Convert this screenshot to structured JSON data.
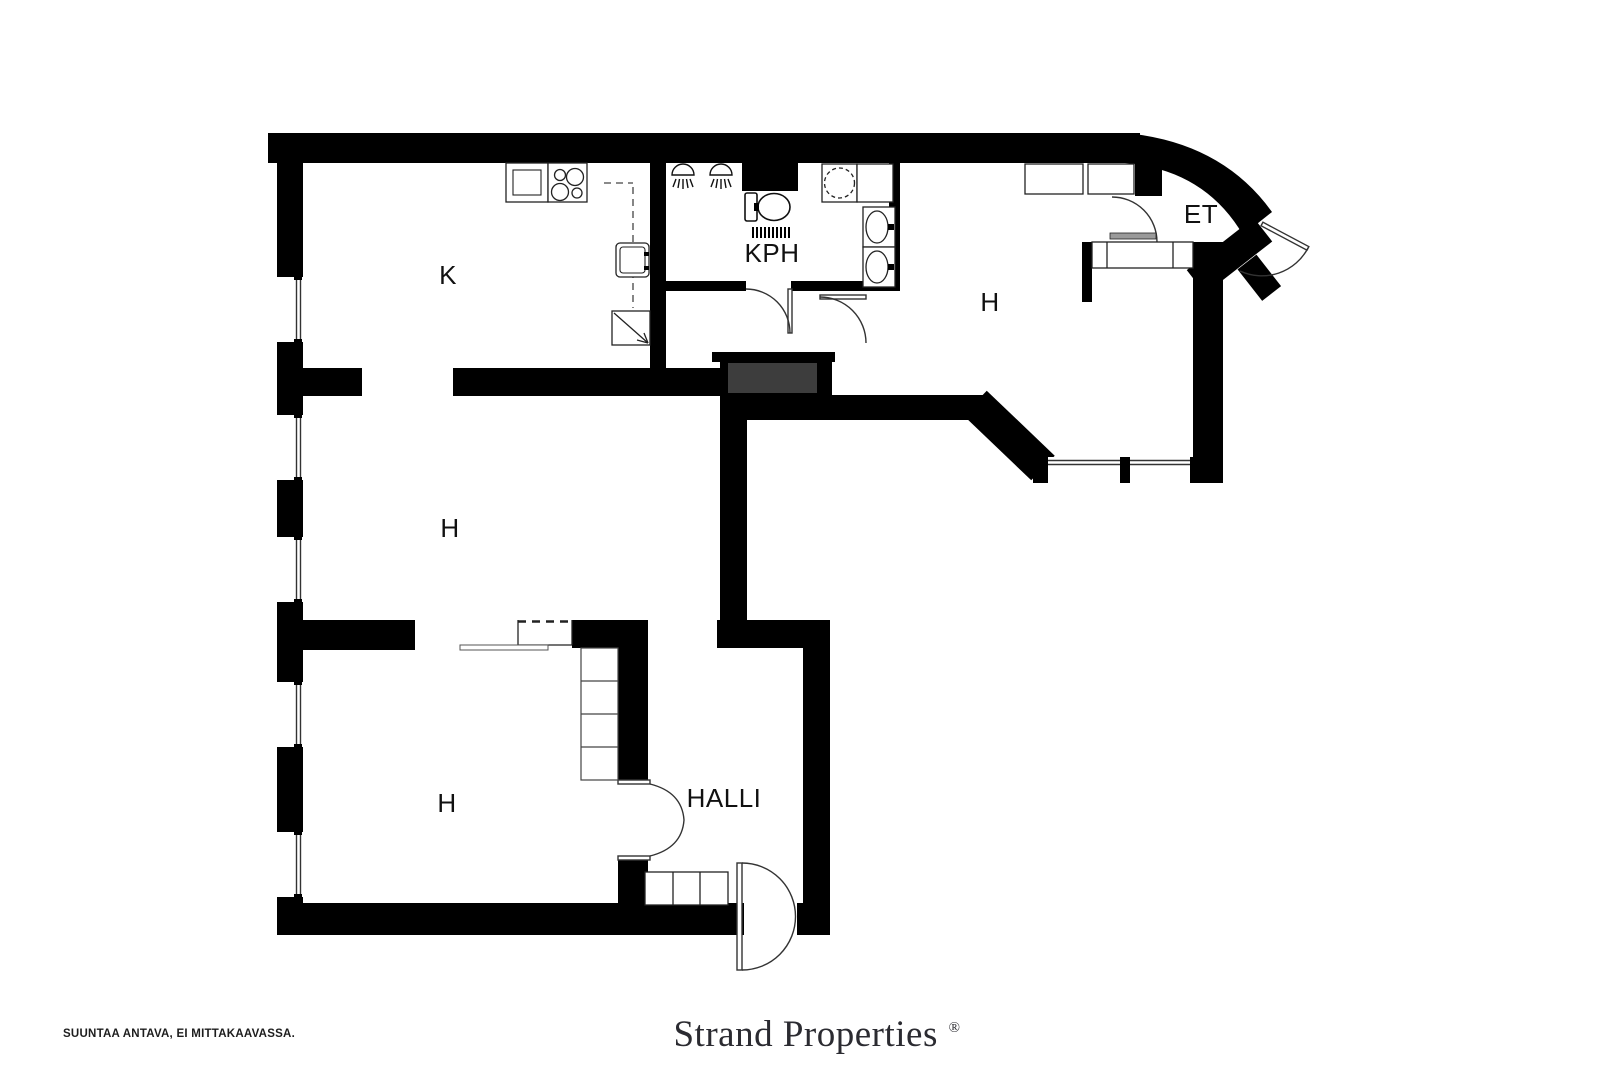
{
  "plan": {
    "rooms": {
      "kitchen": {
        "label": "K"
      },
      "bathroom": {
        "label": "KPH"
      },
      "room_right": {
        "label": "H"
      },
      "entry": {
        "label": "ET"
      },
      "room_middle": {
        "label": "H"
      },
      "room_lower": {
        "label": "H"
      },
      "hall": {
        "label": "HALLI"
      }
    },
    "colors": {
      "wall": "#000000",
      "shaft": "#3d3d3d",
      "background": "#ffffff",
      "fixture_line": "#222222",
      "door_line": "#333333"
    }
  },
  "footer": {
    "disclaimer": "SUUNTAA ANTAVA, EI MITTAKAAVASSA.",
    "brand": "Strand Properties",
    "brand_mark": "®"
  }
}
